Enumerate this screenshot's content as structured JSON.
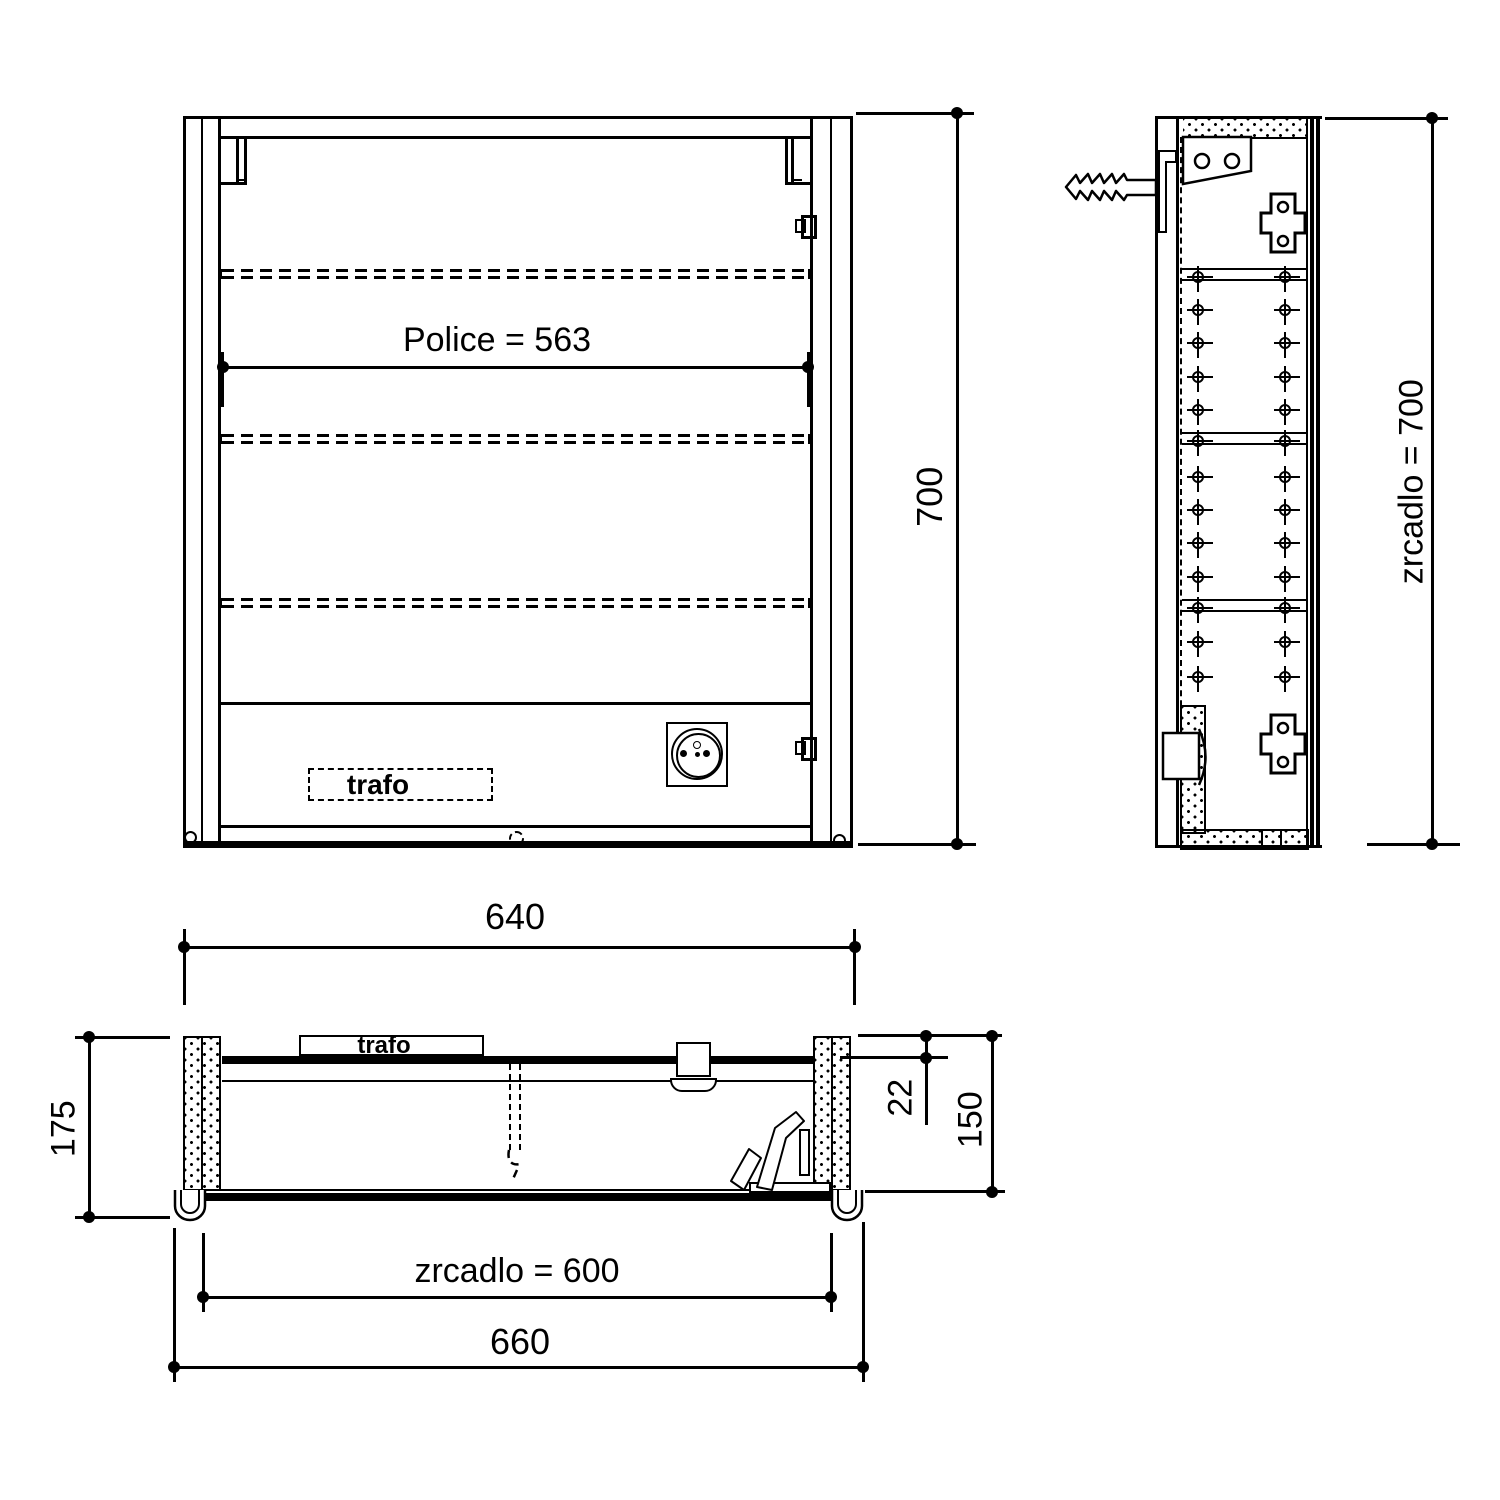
{
  "drawing": {
    "colors": {
      "line": "#000000",
      "background": "#ffffff"
    },
    "front_view": {
      "shelf_dim": "Police = 563",
      "trafo_label": "trafo",
      "height_dim": "700"
    },
    "side_view": {
      "mirror_height_dim": "zrcadlo = 700"
    },
    "plan_view": {
      "width_dim": "640",
      "depth_dim": "175",
      "panel_thickness_dim": "22",
      "inner_depth_dim": "150",
      "mirror_width_dim": "zrcadlo = 600",
      "overall_width_dim": "660",
      "trafo_label": "trafo"
    }
  }
}
